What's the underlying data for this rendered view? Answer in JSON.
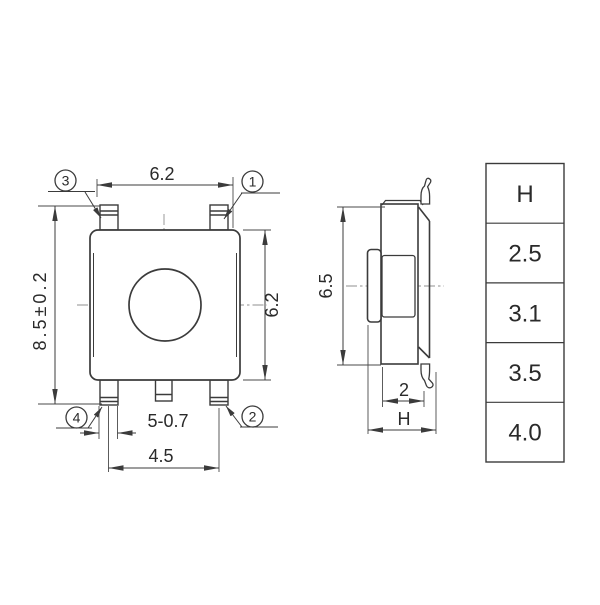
{
  "drawing": {
    "type": "tact-switch-dimension-drawing",
    "front_view": {
      "dimensions": {
        "top_width": "6.2",
        "overall_height": "8.5±0.2",
        "side_height": "6.2",
        "pin_width": "5-0.7",
        "pin_spacing": "4.5"
      },
      "callouts": {
        "top_left": "3",
        "top_right": "1",
        "bottom_left": "4",
        "bottom_right": "2"
      }
    },
    "side_view": {
      "dimensions": {
        "depth": "6.5",
        "base_width": "2",
        "height": "H"
      }
    },
    "height_table": {
      "header": "H",
      "rows": [
        "2.5",
        "3.1",
        "3.5",
        "4.0"
      ]
    },
    "colors": {
      "line": "#3b3b3b",
      "thin_line": "#4a4a4a",
      "centerline": "#8f8f8f",
      "text": "#2a2a2a",
      "background": "#ffffff"
    }
  }
}
